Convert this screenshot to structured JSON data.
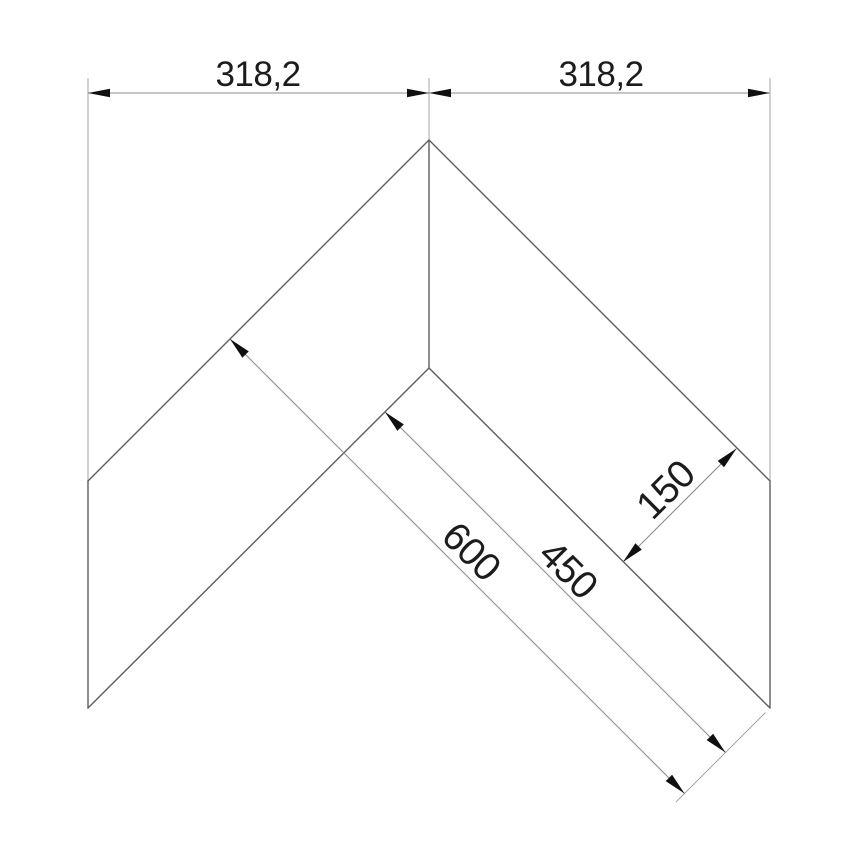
{
  "drawing": {
    "colors": {
      "object_line": "#5e5e5e",
      "dimension_line": "#8d8d8d",
      "extension_line": "#a6a6a6",
      "arrow": "#101010",
      "text": "#1c1c1c",
      "background": "#ffffff"
    },
    "dimensions": {
      "top_left": "318,2",
      "top_right": "318,2",
      "total_width": "600",
      "inner_edge": "450",
      "panel_width": "150"
    }
  }
}
